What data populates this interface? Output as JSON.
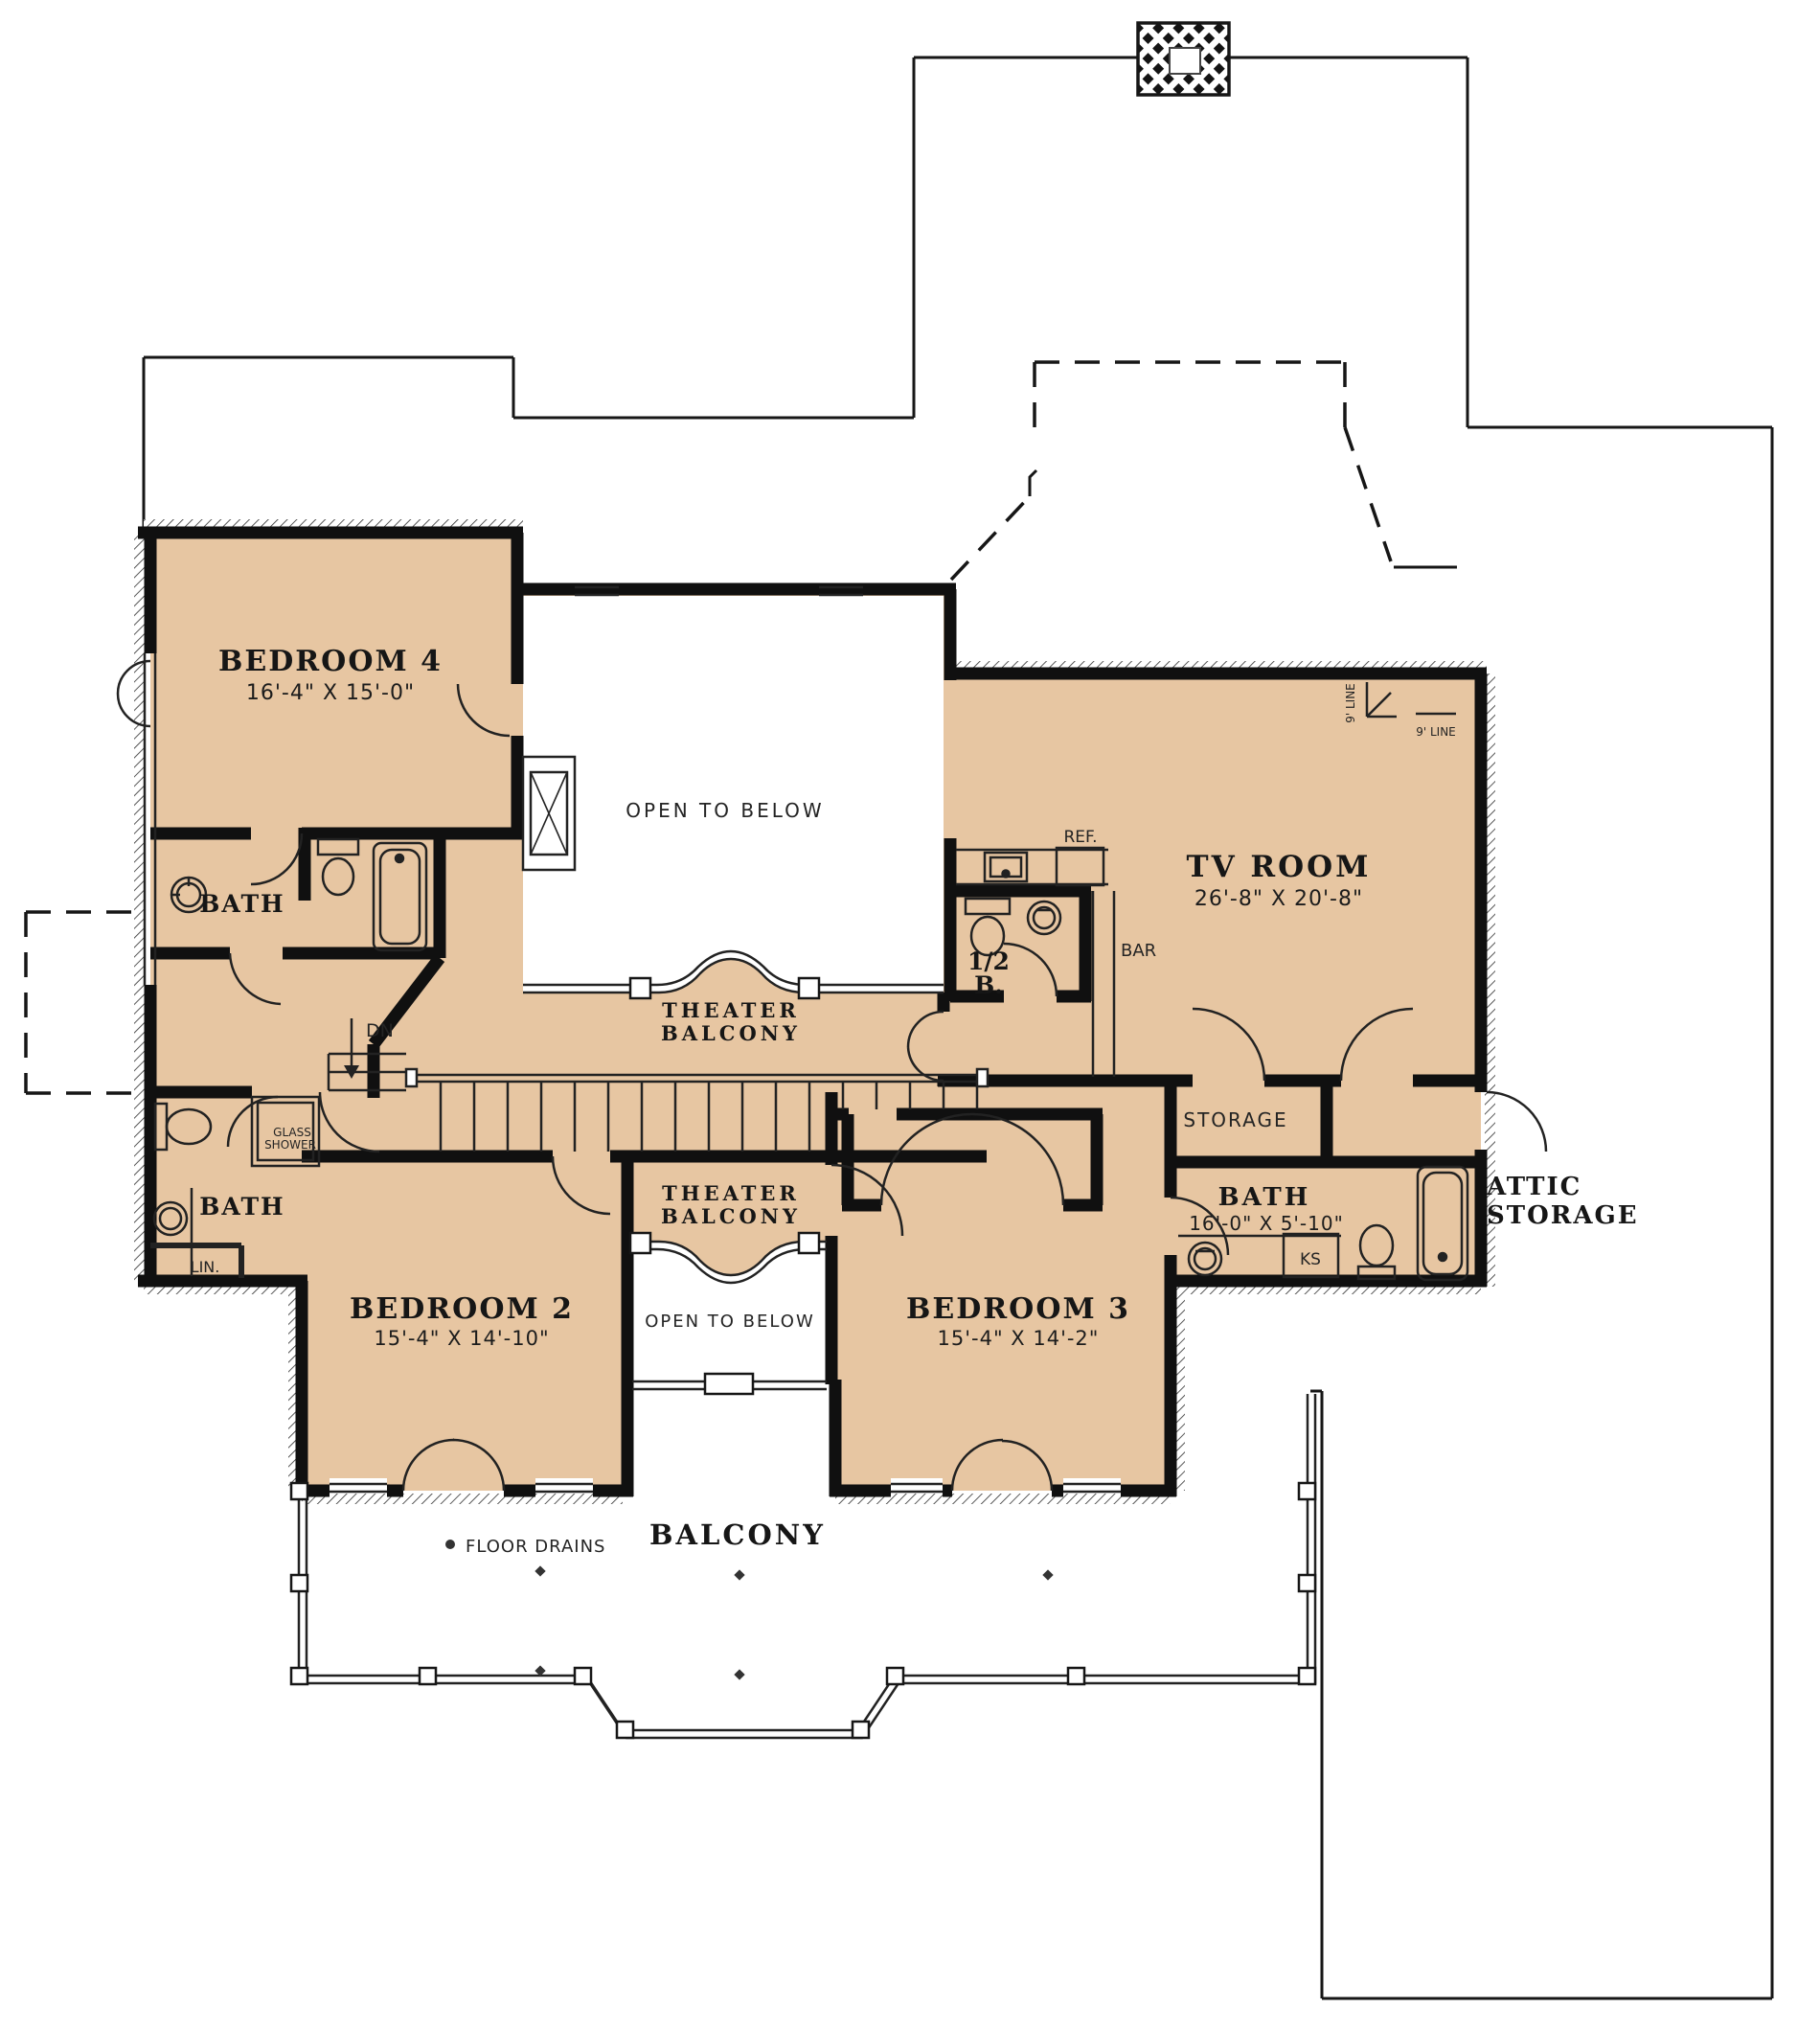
{
  "colors": {
    "floor_fill": "#e7c6a2",
    "wall": "#111111",
    "background": "#ffffff"
  },
  "rooms": {
    "bedroom_4": {
      "name": "BEDROOM 4",
      "dims": "16'-4\" X 15'-0\""
    },
    "bedroom_2": {
      "name": "BEDROOM 2",
      "dims": "15'-4\" X 14'-10\""
    },
    "bedroom_3": {
      "name": "BEDROOM 3",
      "dims": "15'-4\" X 14'-2\""
    },
    "tv_room": {
      "name": "TV ROOM",
      "dims": "26'-8\" X 20'-8\""
    },
    "bath_right": {
      "name": "BATH",
      "dims": "16'-0\" X 5'-10\""
    },
    "bath_upper_left": {
      "name": "BATH"
    },
    "bath_lower_left": {
      "name": "BATH"
    },
    "half_bath": {
      "line1": "1/2",
      "line2": "B."
    },
    "storage": {
      "name": "STORAGE"
    },
    "attic_storage": {
      "line1": "ATTIC",
      "line2": "STORAGE"
    },
    "balcony": {
      "name": "BALCONY"
    },
    "theater_balcony_upper": {
      "line1": "THEATER",
      "line2": "BALCONY"
    },
    "theater_balcony_lower": {
      "line1": "THEATER",
      "line2": "BALCONY"
    },
    "open_to_below_upper": {
      "name": "OPEN TO BELOW"
    },
    "open_to_below_lower": {
      "name": "OPEN TO BELOW"
    }
  },
  "annotations": {
    "ref": "REF.",
    "bar": "BAR",
    "dn": "DN",
    "ks": "KS",
    "lin": "LIN.",
    "glass_shower_line1": "GLASS",
    "glass_shower_line2": "SHOWER",
    "floor_drains": "FLOOR DRAINS",
    "ceiling_line_vertical": "9' LINE",
    "ceiling_line_horizontal": "9' LINE"
  }
}
